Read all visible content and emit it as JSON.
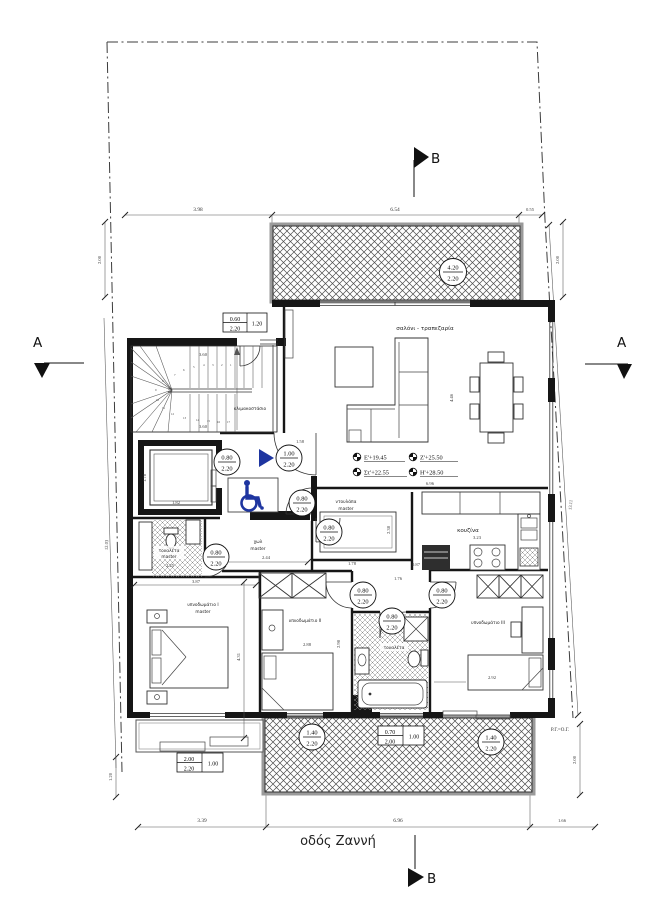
{
  "colors": {
    "accent_blue": "#1e35a0",
    "wall": "#161616"
  },
  "street": {
    "label": "οδός Ζαννή"
  },
  "boundary": {
    "note": "Ρ.Γ.=Ο.Γ."
  },
  "sections": {
    "a": "A",
    "b": "B"
  },
  "rooms": {
    "living": "σαλόνι - τραπεζαρία",
    "stairwell": "κλιμακοστάσιο",
    "hall_line1": "χωλ",
    "hall_line2": "master",
    "closet_line1": "ντουλάπα",
    "closet_line2": "master",
    "wc_master_line1": "τουαλέτα",
    "wc_master_line2": "master",
    "kitchen": "κουζίνα",
    "bedroom1_line1": "υπνοδωμάτιο Ι",
    "bedroom1_line2": "master",
    "bedroom2": "υπνοδωμάτιο ΙΙ",
    "bedroom3": "υπνοδωμάτιο ΙΙΙ",
    "bathroom": "τουαλέτα"
  },
  "levels": {
    "e": "Ε'+19.45",
    "st": "Στ'+22.55",
    "z": "Ζ'+25.50",
    "h": "Η'+28.50"
  },
  "doors": {
    "balcony_top_t": "4.20",
    "balcony_top_b": "2.20",
    "elevator_t": "0.80",
    "elevator_b": "2.20",
    "entrance_t": "1.00",
    "entrance_b": "2.20",
    "hall_t": "0.80",
    "hall_b": "2.20",
    "closet_t": "0.80",
    "closet_b": "2.20",
    "wc_master_t": "0.80",
    "wc_master_b": "2.20",
    "bedroom2_t": "0.80",
    "bedroom2_b": "2.20",
    "bedroom3_t": "0.80",
    "bedroom3_b": "2.20",
    "bathroom_t": "0.80",
    "bathroom_b": "2.20",
    "balcony_left_t": "1.40",
    "balcony_left_b": "2.20",
    "balcony_right_t": "1.40",
    "balcony_right_b": "2.20"
  },
  "windows": {
    "stair_w": "0.60",
    "stair_h": "2.20",
    "stair_sill": "1.20",
    "master_w": "2.00",
    "master_h": "2.20",
    "master_sill": "1.00",
    "bath_w": "0.70",
    "bath_h": "2.00",
    "bath_sill": "1.00"
  },
  "dims": {
    "top1": "3.98",
    "top2": "6.54",
    "top3": "0.55",
    "bottom1": "3.39",
    "bottom2": "6.96",
    "bottom3": "1.66",
    "left_top": "2.00",
    "right_top": "2.00",
    "left_bottom": "1.20",
    "right_bottom": "2.00",
    "left_side": "12.03",
    "right_side": "13.11",
    "stair_top": "3.60",
    "stair_bottom": "3.60",
    "entry": "1.58",
    "elevator_w": "1.82",
    "elevator_h": "1.78",
    "hall": "2.44",
    "wc_master": "2.25",
    "closet_w": "1.78",
    "closet_h": "2.38",
    "closet_gap": "0.87",
    "corridor": "1.76",
    "kitchen_w": "3.23",
    "kitchen_top": "6.96",
    "living_h": "4.46",
    "master_w": "3.87",
    "master_h": "4.31",
    "bedroom2_w": "2.88",
    "bedroom2_h": "2.98",
    "bedroom3_w": "2.92"
  },
  "stairs": {
    "steps": [
      "1",
      "2",
      "3",
      "4",
      "5",
      "6",
      "7",
      "8",
      "9",
      "10",
      "11",
      "12",
      "13",
      "14",
      "15",
      "16",
      "17"
    ]
  }
}
